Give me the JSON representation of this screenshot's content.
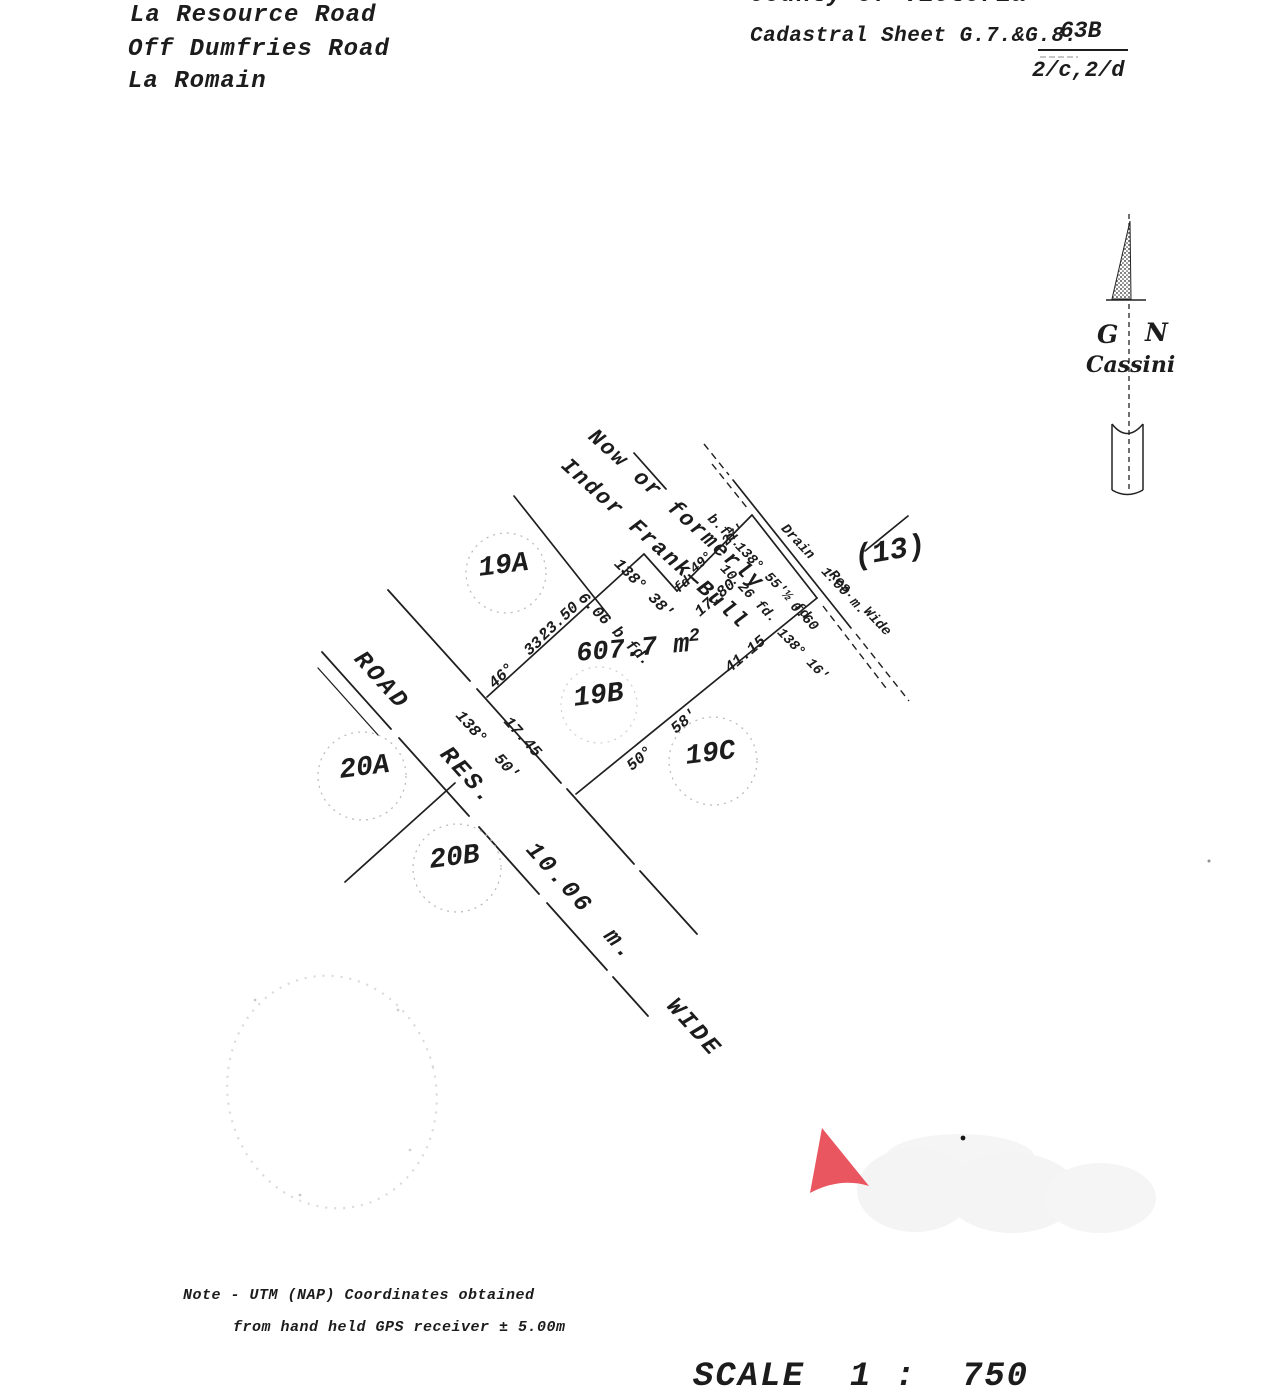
{
  "document": {
    "address_line1": "La Resource Road",
    "address_line2": "Off Dumfries Road",
    "address_line3": "La Romain",
    "county": "County of Victoria",
    "cadastral_sheet": "Cadastral Sheet G.7.&G.8.",
    "sheet_number": "63B",
    "sheet_code": "2/c,2/d",
    "note_line1": "Note - UTM (NAP) Coordinates obtained",
    "note_line2": "from hand held GPS receiver ± 5.00m",
    "scale_text": "SCALE  1 :  750"
  },
  "north_arrow": {
    "letter_left": "G",
    "letter_right": "N",
    "projection": "Cassini"
  },
  "neighbor": {
    "line1": "Now or formerly",
    "line2": "Indor Frank—Bull"
  },
  "road_label": "ROAD  RES.  10.06 m.  WIDE",
  "parcels": {
    "lot_19a": "19A",
    "lot_19b": "19B",
    "lot_19c": "19C",
    "lot_20a": "20A",
    "lot_20b": "20B",
    "lot_13": "(13)",
    "area_value": "607.7 m",
    "area_sup": "2"
  },
  "measurements": {
    "neighbor_jog_bearing": "138° 38'",
    "neighbor_jog_dist": "6.06 b.fd.",
    "nw_dist": "23.50",
    "nw_bearing": "46°  33'",
    "north_found": "fd.",
    "north_dist": "17.80",
    "north_bearing": "49°  27'",
    "corner_found": "b.fd.",
    "drain_seg_bearing": "138° 55'½ fd.",
    "drain_seg_dist": "10.26 fd.",
    "drain_tie": "0.60",
    "se_ext_bearing": "138° 16'",
    "se_dist": "41.15",
    "se_bearing": "50°   58'",
    "front_bearing": "138°  50'",
    "front_dist": "17.45"
  },
  "drain": {
    "label_line1": "Drain  1.00 m.",
    "label_line2": "Res.  Wide"
  }
}
